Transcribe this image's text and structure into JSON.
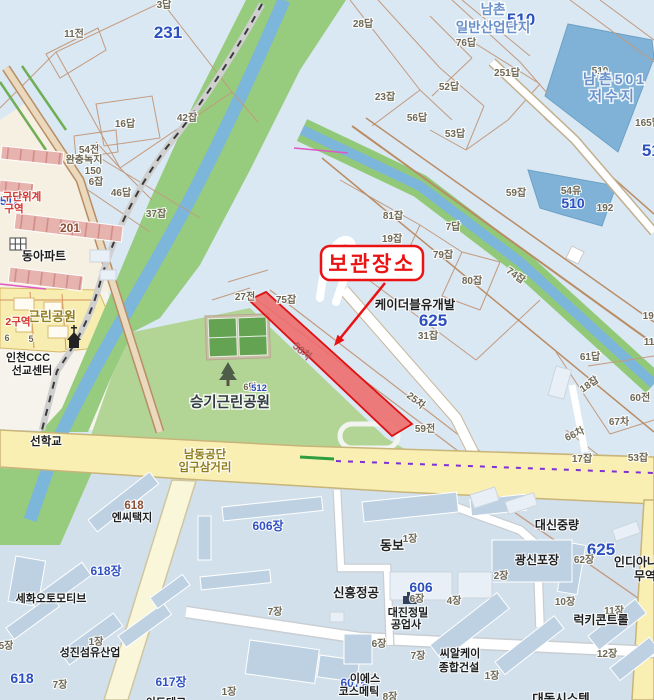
{
  "map": {
    "colors": {
      "parcel_base": "#d9e8f3",
      "industrial_base": "#d2e0ec",
      "greenbelt": "#97cb7d",
      "park_green": "#b2d596",
      "stream_blue": "#7cb6da",
      "reservoir_blue": "#7fb2d6",
      "main_road_yellow": "#f9efb3",
      "minor_road": "#faf6da",
      "parcel_line": "#c49a7e",
      "highlight_red_fill": "#ee6a6a",
      "highlight_red_border": "#dd1111",
      "callout_red": "#ea1212",
      "apartment_pink": "#e7b3ae",
      "building_blue": "#bdd1e2",
      "cream_zone": "#f6f0e3",
      "yellow_zone": "#f8edb0"
    },
    "callout": {
      "text": "보관장소",
      "target_parcel": "58차"
    },
    "labels": [
      {
        "t": "3답",
        "x": 164,
        "y": 8,
        "c": "pnum"
      },
      {
        "t": "231",
        "x": 168,
        "y": 38,
        "c": "bluebig"
      },
      {
        "t": "11전",
        "x": 74,
        "y": 37,
        "c": "pnum"
      },
      {
        "t": "16답",
        "x": 125,
        "y": 127,
        "c": "pnum"
      },
      {
        "t": "42잡",
        "x": 187,
        "y": 121,
        "c": "pnum"
      },
      {
        "t": "28답",
        "x": 363,
        "y": 27,
        "c": "pnum"
      },
      {
        "t": "510",
        "x": 521,
        "y": 25,
        "c": "bluebig"
      },
      {
        "t": "남촌",
        "x": 493,
        "y": 14,
        "c": "hname"
      },
      {
        "t": "일반산업단지",
        "x": 493,
        "y": 32,
        "c": "hname"
      },
      {
        "t": "76답",
        "x": 466,
        "y": 46,
        "c": "pnum"
      },
      {
        "t": "251답",
        "x": 507,
        "y": 76,
        "c": "pnum"
      },
      {
        "t": "23잡",
        "x": 385,
        "y": 100,
        "c": "pnum"
      },
      {
        "t": "52답",
        "x": 449,
        "y": 90,
        "c": "pnum"
      },
      {
        "t": "56답",
        "x": 417,
        "y": 121,
        "c": "pnum"
      },
      {
        "t": "53답",
        "x": 455,
        "y": 137,
        "c": "pnum"
      },
      {
        "t": "510",
        "x": 600,
        "y": 74,
        "c": "pnum"
      },
      {
        "t": "남촌501",
        "x": 615,
        "y": 84,
        "c": "hname2"
      },
      {
        "t": "저수지",
        "x": 613,
        "y": 101,
        "c": "hname2"
      },
      {
        "t": "165답",
        "x": 648,
        "y": 126,
        "c": "pnum"
      },
      {
        "t": "510",
        "x": 656,
        "y": 156,
        "c": "bluebig"
      },
      {
        "t": "54전",
        "x": 89,
        "y": 153,
        "c": "pnum"
      },
      {
        "t": "완충녹지",
        "x": 84,
        "y": 163,
        "c": "pnum"
      },
      {
        "t": "150",
        "x": 93,
        "y": 174,
        "c": "pnum"
      },
      {
        "t": "6잡",
        "x": 96,
        "y": 185,
        "c": "pnum"
      },
      {
        "t": "46답",
        "x": 121,
        "y": 196,
        "c": "pnum"
      },
      {
        "t": "37잡",
        "x": 156,
        "y": 217,
        "c": "pnum"
      },
      {
        "t": "512",
        "x": 10,
        "y": 205,
        "c": "bluemid"
      },
      {
        "t": "구단위계",
        "x": 22,
        "y": 200,
        "c": "red"
      },
      {
        "t": "구역",
        "x": 14,
        "y": 212,
        "c": "red"
      },
      {
        "t": "201",
        "x": 70,
        "y": 232,
        "c": "brown",
        "s": 12
      },
      {
        "t": "동아파트",
        "x": 44,
        "y": 260,
        "c": "comp",
        "s": 12
      },
      {
        "t": "59잡",
        "x": 516,
        "y": 196,
        "c": "pnum"
      },
      {
        "t": "54유",
        "x": 571,
        "y": 194,
        "c": "pnum"
      },
      {
        "t": "510",
        "x": 573,
        "y": 208,
        "c": "bluebig2"
      },
      {
        "t": "192",
        "x": 605,
        "y": 211,
        "c": "pnum"
      },
      {
        "t": "81잡",
        "x": 393,
        "y": 219,
        "c": "pnum"
      },
      {
        "t": "19잡",
        "x": 392,
        "y": 242,
        "c": "pnum"
      },
      {
        "t": "7답",
        "x": 453,
        "y": 230,
        "c": "pnum"
      },
      {
        "t": "79잡",
        "x": 443,
        "y": 258,
        "c": "pnum"
      },
      {
        "t": "80잡",
        "x": 472,
        "y": 284,
        "c": "pnum"
      },
      {
        "t": "74잡",
        "x": 514,
        "y": 278,
        "c": "pnum",
        "r": 35
      },
      {
        "t": "27전",
        "x": 245,
        "y": 300,
        "c": "pnum"
      },
      {
        "t": "75잡",
        "x": 286,
        "y": 303,
        "c": "pnum"
      },
      {
        "t": "케이더블유개발",
        "x": 415,
        "y": 309,
        "c": "comp",
        "s": 12.5
      },
      {
        "t": "625",
        "x": 433,
        "y": 326,
        "c": "bluebig"
      },
      {
        "t": "31잡",
        "x": 428,
        "y": 339,
        "c": "pnum"
      },
      {
        "t": "근린공원",
        "x": 52,
        "y": 321,
        "c": "inter",
        "s": 13
      },
      {
        "t": "2구역",
        "x": 18,
        "y": 325,
        "c": "red"
      },
      {
        "t": "6",
        "x": 7,
        "y": 341,
        "c": "pnum2"
      },
      {
        "t": "5",
        "x": 31,
        "y": 342,
        "c": "pnum2"
      },
      {
        "t": "인천CCC",
        "x": 28,
        "y": 361,
        "c": "comp"
      },
      {
        "t": "선교센터",
        "x": 32,
        "y": 374,
        "c": "comp"
      },
      {
        "t": "58차",
        "x": 300,
        "y": 354,
        "c": "redparcel",
        "r": 41
      },
      {
        "t": "6답",
        "x": 250,
        "y": 390,
        "c": "pnum2"
      },
      {
        "t": "512",
        "x": 259,
        "y": 391,
        "c": "blue512"
      },
      {
        "t": "승기근린공원",
        "x": 230,
        "y": 407,
        "c": "park"
      },
      {
        "t": "25차",
        "x": 414,
        "y": 403,
        "c": "pnum",
        "r": 38
      },
      {
        "t": "59전",
        "x": 425,
        "y": 432,
        "c": "pnum"
      },
      {
        "t": "61답",
        "x": 590,
        "y": 360,
        "c": "pnum"
      },
      {
        "t": "18잡",
        "x": 591,
        "y": 387,
        "c": "pnum",
        "r": -35
      },
      {
        "t": "60전",
        "x": 640,
        "y": 401,
        "c": "pnum"
      },
      {
        "t": "67차",
        "x": 619,
        "y": 425,
        "c": "pnum"
      },
      {
        "t": "66차",
        "x": 576,
        "y": 437,
        "c": "pnum",
        "r": -25
      },
      {
        "t": "17잡",
        "x": 582,
        "y": 462,
        "c": "pnum"
      },
      {
        "t": "53잡",
        "x": 638,
        "y": 461,
        "c": "pnum"
      },
      {
        "t": "193",
        "x": 651,
        "y": 319,
        "c": "pnum"
      },
      {
        "t": "11",
        "x": 649,
        "y": 345,
        "c": "pnum"
      },
      {
        "t": "선학교",
        "x": 46,
        "y": 445,
        "c": "road"
      },
      {
        "t": "남동공단",
        "x": 205,
        "y": 458,
        "c": "inter"
      },
      {
        "t": "입구삼거리",
        "x": 205,
        "y": 471,
        "c": "inter"
      },
      {
        "t": "618",
        "x": 134,
        "y": 509,
        "c": "brown"
      },
      {
        "t": "엔씨택지",
        "x": 132,
        "y": 521,
        "c": "comp"
      },
      {
        "t": "618장",
        "x": 106,
        "y": 575,
        "c": "bluemid"
      },
      {
        "t": "세화오토모티브",
        "x": 51,
        "y": 602,
        "c": "comp"
      },
      {
        "t": "1장",
        "x": 96,
        "y": 645,
        "c": "pnum"
      },
      {
        "t": "성진섬유산업",
        "x": 90,
        "y": 656,
        "c": "comp"
      },
      {
        "t": "5장",
        "x": 6,
        "y": 649,
        "c": "pnum"
      },
      {
        "t": "618",
        "x": 22,
        "y": 683,
        "c": "bluebig2"
      },
      {
        "t": "7장",
        "x": 60,
        "y": 688,
        "c": "pnum"
      },
      {
        "t": "617장",
        "x": 171,
        "y": 686,
        "c": "bluemid"
      },
      {
        "t": "1장",
        "x": 229,
        "y": 695,
        "c": "pnum"
      },
      {
        "t": "이드테크",
        "x": 166,
        "y": 706,
        "c": "comp"
      },
      {
        "t": "606장",
        "x": 268,
        "y": 530,
        "c": "bluemid"
      },
      {
        "t": "7장",
        "x": 275,
        "y": 615,
        "c": "pnum"
      },
      {
        "t": "동보",
        "x": 392,
        "y": 550,
        "c": "comp",
        "s": 13
      },
      {
        "t": "1장",
        "x": 410,
        "y": 542,
        "c": "pnum"
      },
      {
        "t": "신흥정공",
        "x": 356,
        "y": 597,
        "c": "comp",
        "s": 12.5
      },
      {
        "t": "606",
        "x": 421,
        "y": 592,
        "c": "bluebig2"
      },
      {
        "t": "6장",
        "x": 417,
        "y": 602,
        "c": "pnum"
      },
      {
        "t": "대진정밀",
        "x": 408,
        "y": 616,
        "c": "comp"
      },
      {
        "t": "공업사",
        "x": 406,
        "y": 628,
        "c": "comp"
      },
      {
        "t": "6장",
        "x": 379,
        "y": 647,
        "c": "pnum"
      },
      {
        "t": "7장",
        "x": 418,
        "y": 659,
        "c": "pnum"
      },
      {
        "t": "씨알케이",
        "x": 460,
        "y": 657,
        "c": "comp"
      },
      {
        "t": "종합건설",
        "x": 459,
        "y": 671,
        "c": "comp"
      },
      {
        "t": "1장",
        "x": 492,
        "y": 679,
        "c": "pnum"
      },
      {
        "t": "607장",
        "x": 356,
        "y": 687,
        "c": "bluemid"
      },
      {
        "t": "이에스",
        "x": 365,
        "y": 682,
        "c": "comp"
      },
      {
        "t": "코스메틱",
        "x": 359,
        "y": 695,
        "c": "comp"
      },
      {
        "t": "8장",
        "x": 390,
        "y": 700,
        "c": "pnum"
      },
      {
        "t": "대동시스템",
        "x": 561,
        "y": 703,
        "c": "comp",
        "s": 12.5
      },
      {
        "t": "대신중량",
        "x": 557,
        "y": 529,
        "c": "comp",
        "s": 12
      },
      {
        "t": "625",
        "x": 601,
        "y": 555,
        "c": "bluebig"
      },
      {
        "t": "62장",
        "x": 584,
        "y": 563,
        "c": "pnum"
      },
      {
        "t": "인디아나",
        "x": 636,
        "y": 566,
        "c": "comp",
        "s": 12
      },
      {
        "t": "무역",
        "x": 645,
        "y": 580,
        "c": "comp",
        "s": 12
      },
      {
        "t": "광신포장",
        "x": 537,
        "y": 564,
        "c": "comp",
        "s": 12
      },
      {
        "t": "2장",
        "x": 501,
        "y": 579,
        "c": "pnum"
      },
      {
        "t": "4장",
        "x": 454,
        "y": 604,
        "c": "pnum"
      },
      {
        "t": "10장",
        "x": 565,
        "y": 605,
        "c": "pnum"
      },
      {
        "t": "11장",
        "x": 614,
        "y": 614,
        "c": "pnum"
      },
      {
        "t": "럭키콘트롤",
        "x": 601,
        "y": 624,
        "c": "comp",
        "s": 12
      },
      {
        "t": "12장",
        "x": 607,
        "y": 657,
        "c": "pnum"
      },
      {
        "t": "보관장소",
        "x": 372,
        "y": 271,
        "c": "callout",
        "n": "storage-callout-label"
      }
    ]
  }
}
